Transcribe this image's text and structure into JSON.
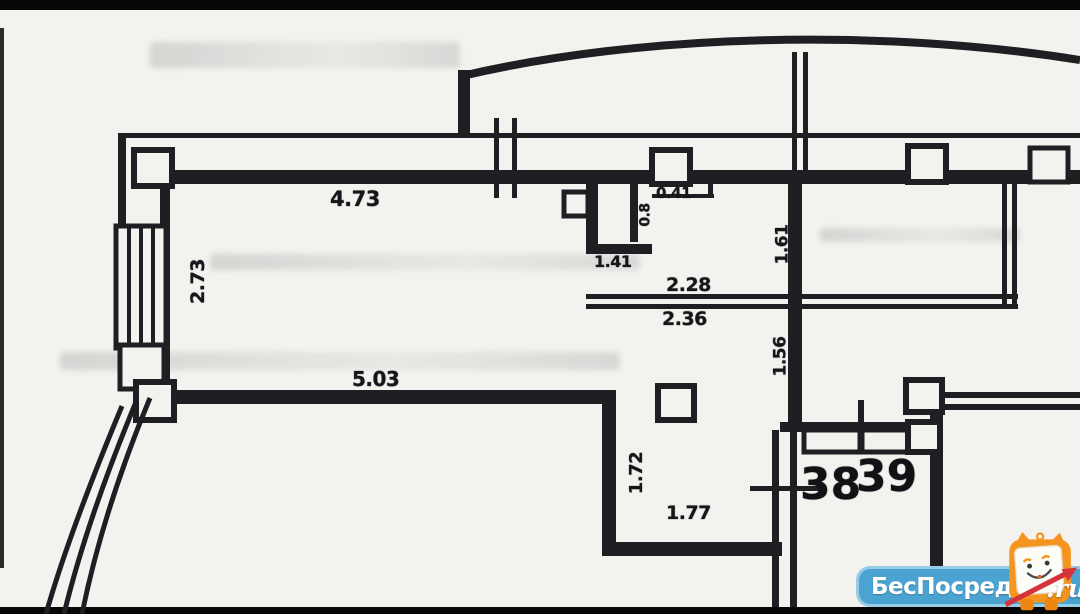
{
  "plan": {
    "type": "apartment-floor-plan-scan",
    "room_numbers": {
      "left": "38",
      "right": "39"
    },
    "dimensions": {
      "top_wall": "4.73",
      "left_wall_vertical": "2.73",
      "bottom_left_wall": "5.03",
      "wc_width": "1.41",
      "wc_door": "0.41",
      "wc_side_vertical": "0.8",
      "hall_inner_width": "2.28",
      "hall_outer_width": "2.36",
      "right_wall_upper_vertical": "1.61",
      "right_wall_lower_vertical": "1.56",
      "step_height_vertical": "1.72",
      "step_width": "1.77"
    },
    "colors": {
      "paper": "#f3f2ee",
      "wall_ink": "#1f1f23",
      "letterbox": "#070707"
    }
  },
  "watermark": {
    "brand": "БесПосредника",
    "tld": ".ru",
    "bar_color": "#4aa3d1",
    "bar_border_color": "#96cde6",
    "mascot": "owl-mascot",
    "mascot_color": "#f5941e",
    "arrow_color": "#d6323b"
  }
}
